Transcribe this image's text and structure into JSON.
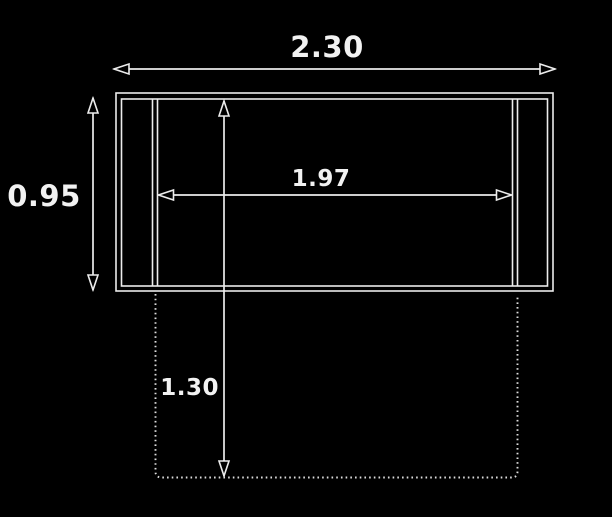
{
  "diagram": {
    "background_color": "#000000",
    "line_color": "#ececec",
    "text_color": "#f2f2f2",
    "labels": {
      "top_width": "2.30",
      "left_height": "0.95",
      "inner_width": "1.97",
      "lower_depth": "1.30"
    }
  }
}
